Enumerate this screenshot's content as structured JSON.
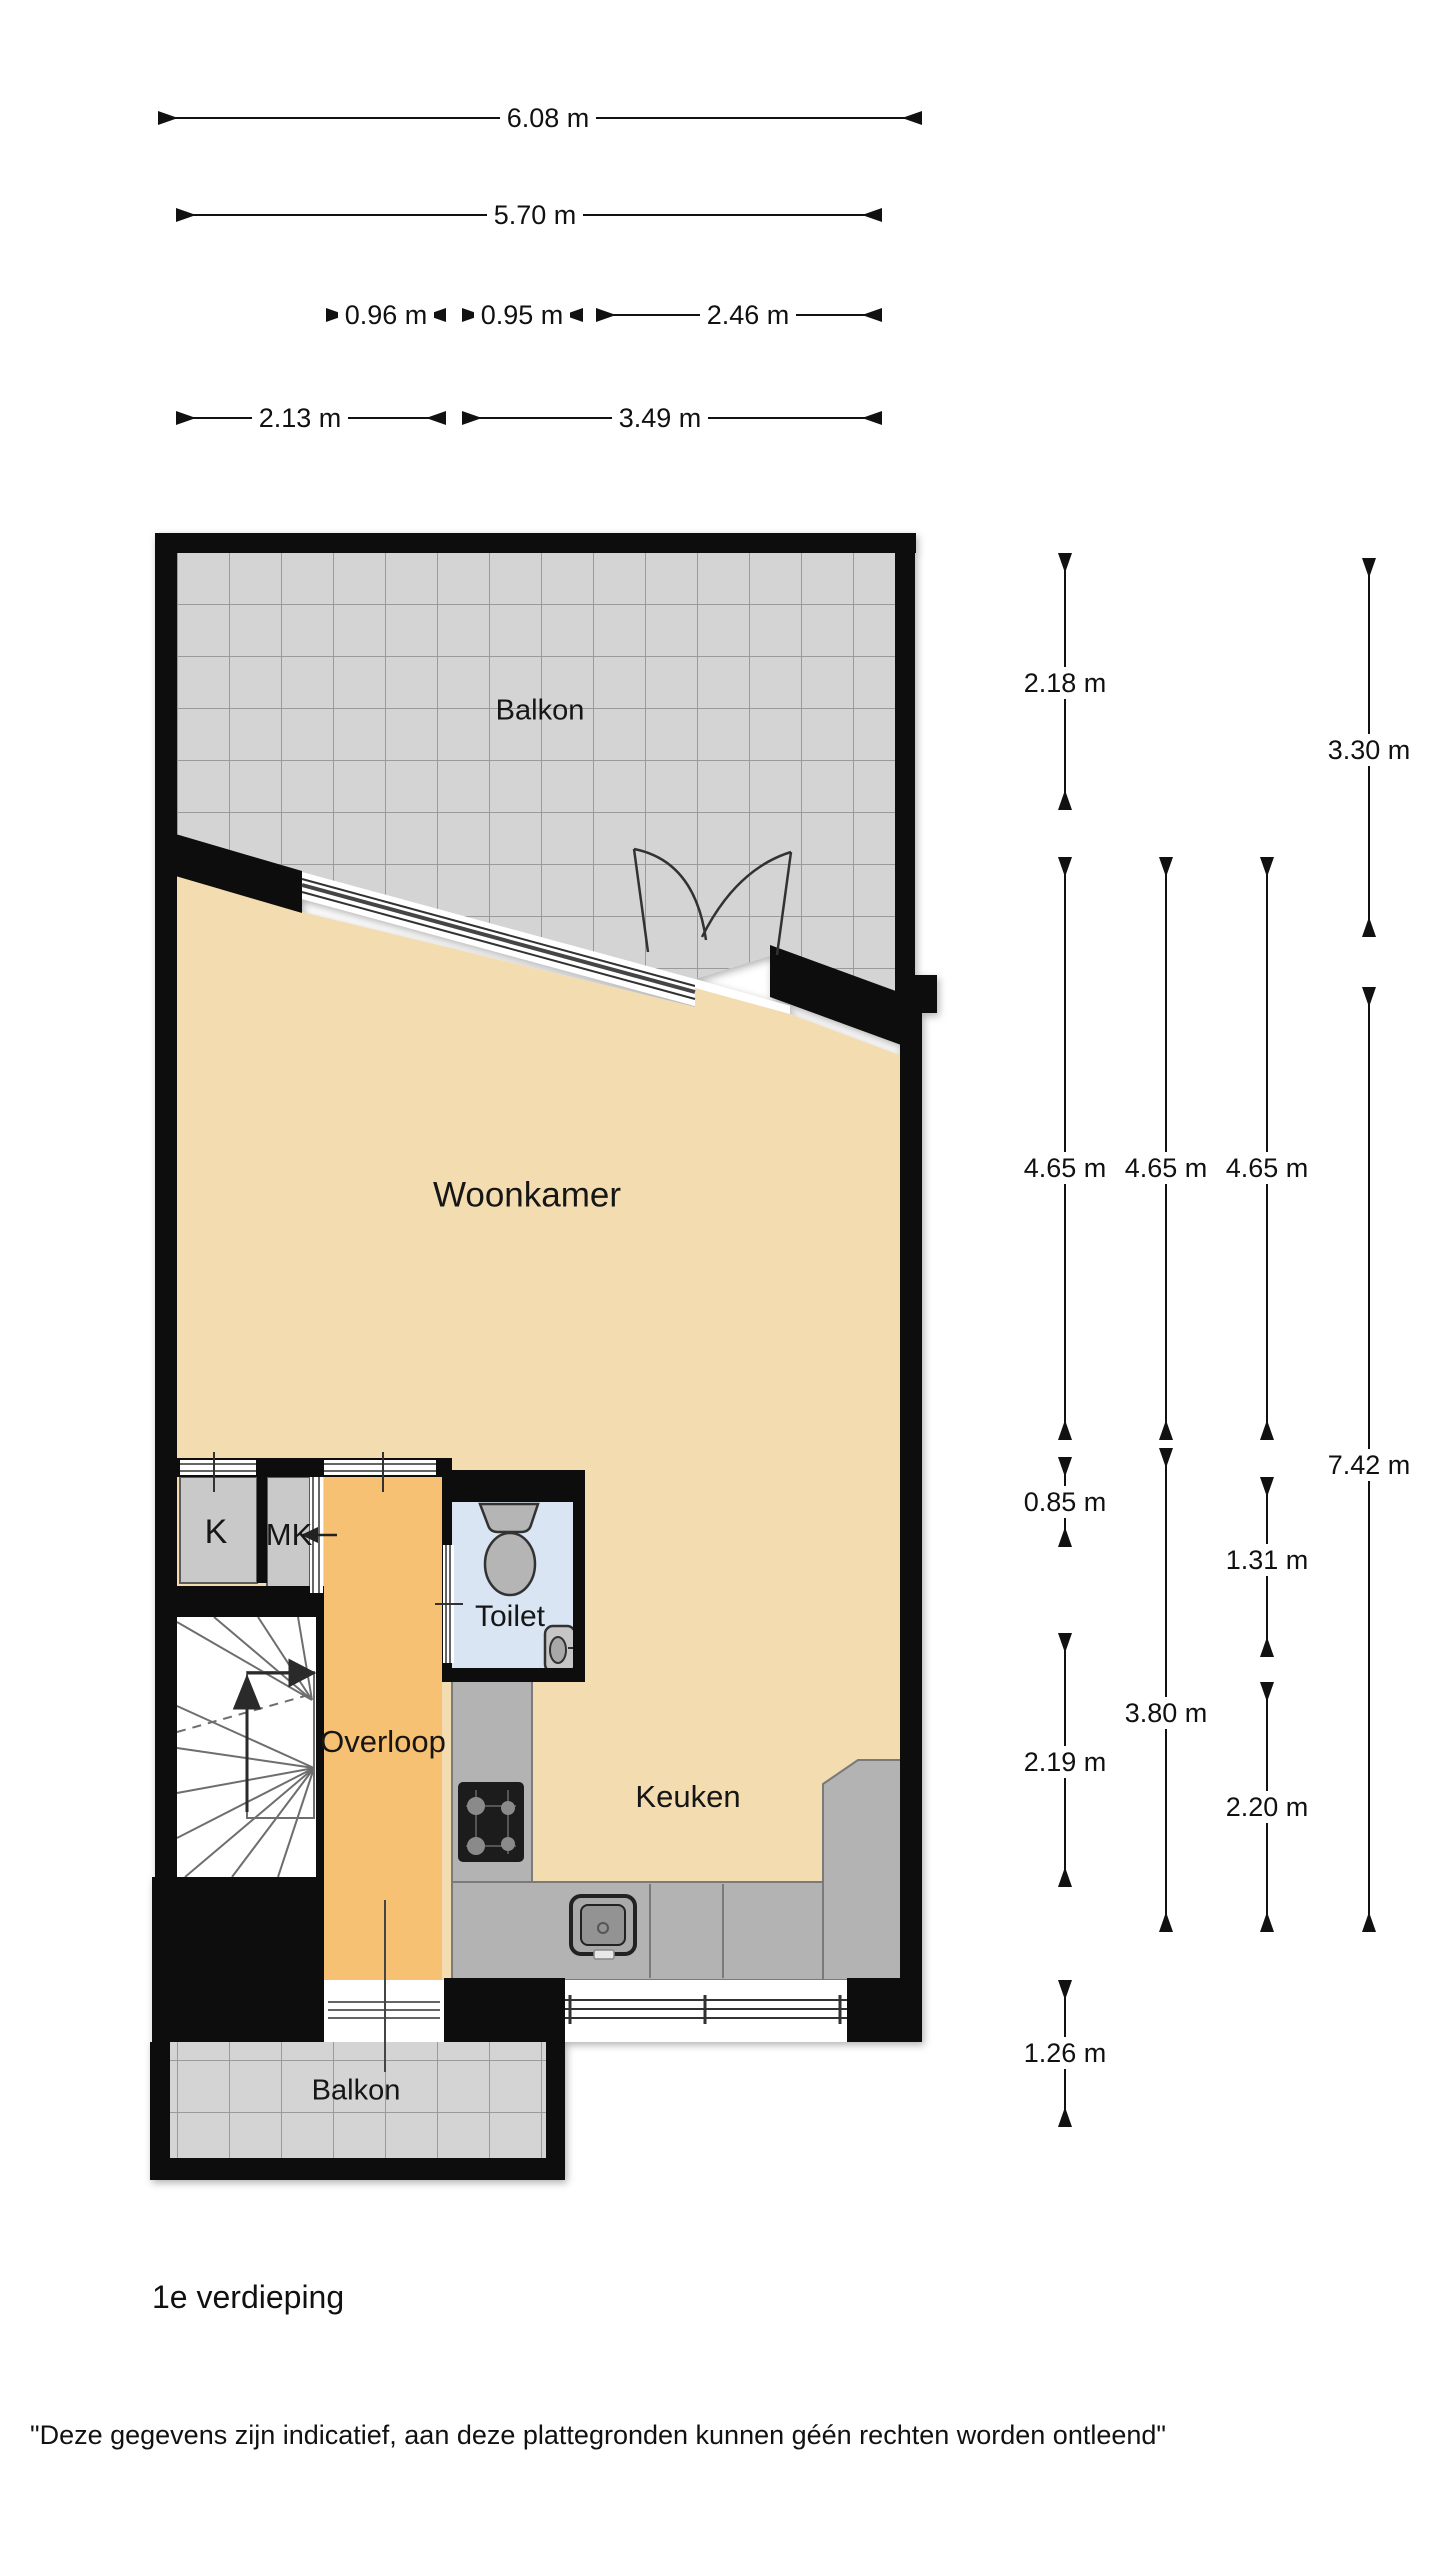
{
  "title": "1e verdieping",
  "disclaimer": "\"Deze gegevens zijn indicatief, aan deze plattegronden kunnen géén rechten worden ontleend\"",
  "rooms": {
    "balkon_top": "Balkon",
    "woonkamer": "Woonkamer",
    "k": "K",
    "mk": "MK",
    "toilet": "Toilet",
    "overloop": "Overloop",
    "keuken": "Keuken",
    "balkon_bottom": "Balkon"
  },
  "dims": {
    "d608": "6.08 m",
    "d570": "5.70 m",
    "d096": "0.96 m",
    "d095": "0.95 m",
    "d246": "2.46 m",
    "d213": "2.13 m",
    "d349": "3.49 m",
    "d218": "2.18 m",
    "d330": "3.30 m",
    "d465a": "4.65 m",
    "d465b": "4.65 m",
    "d465c": "4.65 m",
    "d085": "0.85 m",
    "d131": "1.31 m",
    "d742": "7.42 m",
    "d219": "2.19 m",
    "d380": "3.80 m",
    "d220": "2.20 m",
    "d126": "1.26 m"
  },
  "colors": {
    "wall": "#0e0e0e",
    "floor-beige": "#f2dcb0",
    "overloop-orange": "#f6c172",
    "toilet-blue": "#d9e5f3",
    "balkon-gray": "#d4d4d4",
    "grid-line": "#9a9a9a",
    "counter-gray": "#b3b3b3",
    "closet-gray": "#c9c9c9",
    "fixture-gray": "#b5b5b5"
  }
}
